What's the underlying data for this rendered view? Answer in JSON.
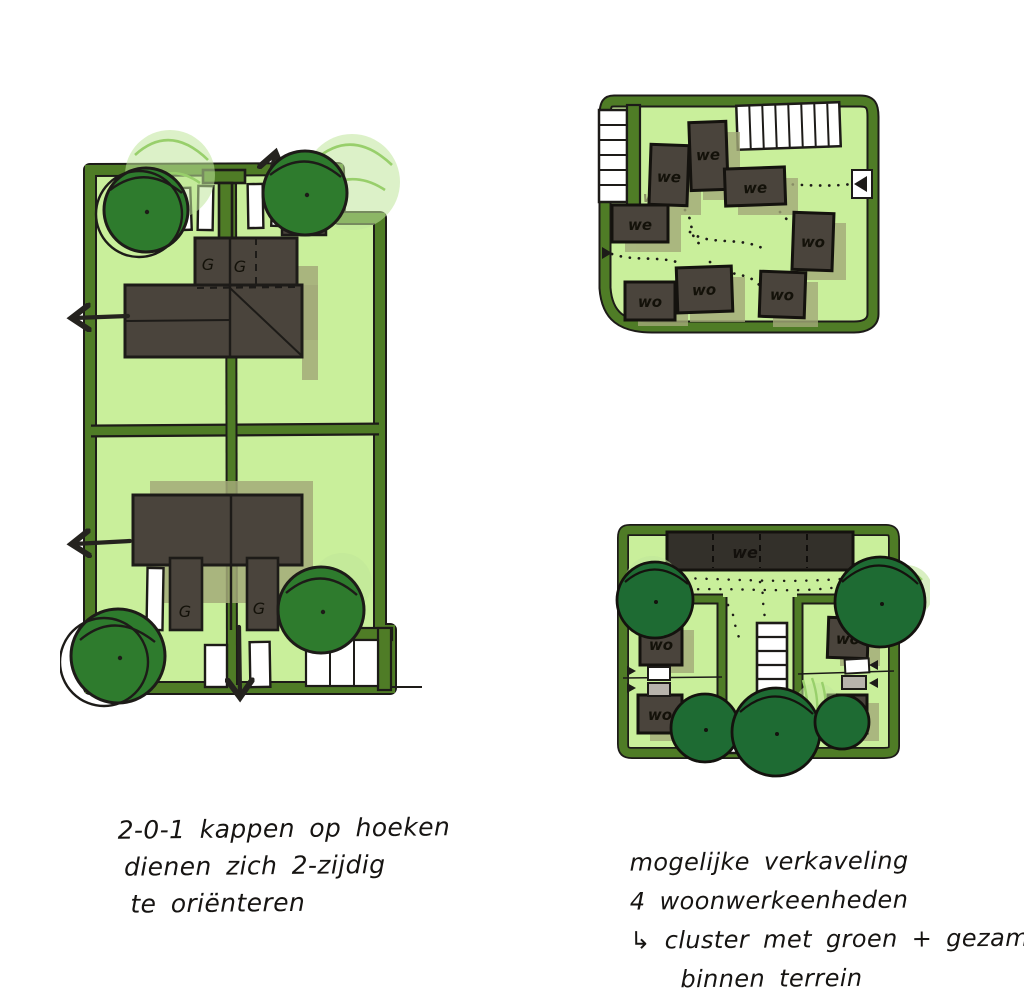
{
  "captions": {
    "left": {
      "line1": "2-0-1 kappen op hoeken",
      "line2": "dienen zich 2-zijdig",
      "line3": "te oriënteren"
    },
    "right": {
      "line1": "mogelijke verkaveling",
      "line2": "4 woonwerkeenheden",
      "line3": "↳ cluster met groen + gezamelijk",
      "line4": "binnen terrein"
    }
  },
  "labels": {
    "garage": "G",
    "we": "we",
    "wo": "wo"
  },
  "colors": {
    "plot_border_green": "#4f7c26",
    "plot_fill_green": "#c9ef9b",
    "shadow_olive": "#a3aa79",
    "tree_green": "#2e7b2d",
    "tree_green_dark": "#1e6b33",
    "ghost_green": "#bfe59a",
    "ghost_stroke_green": "#98cf6b",
    "building_dark": "#4a443c",
    "building_bar_dark": "#33302a",
    "ink": "#1d1b18",
    "white": "#ffffff",
    "gray_square": "#b8b4ac"
  }
}
